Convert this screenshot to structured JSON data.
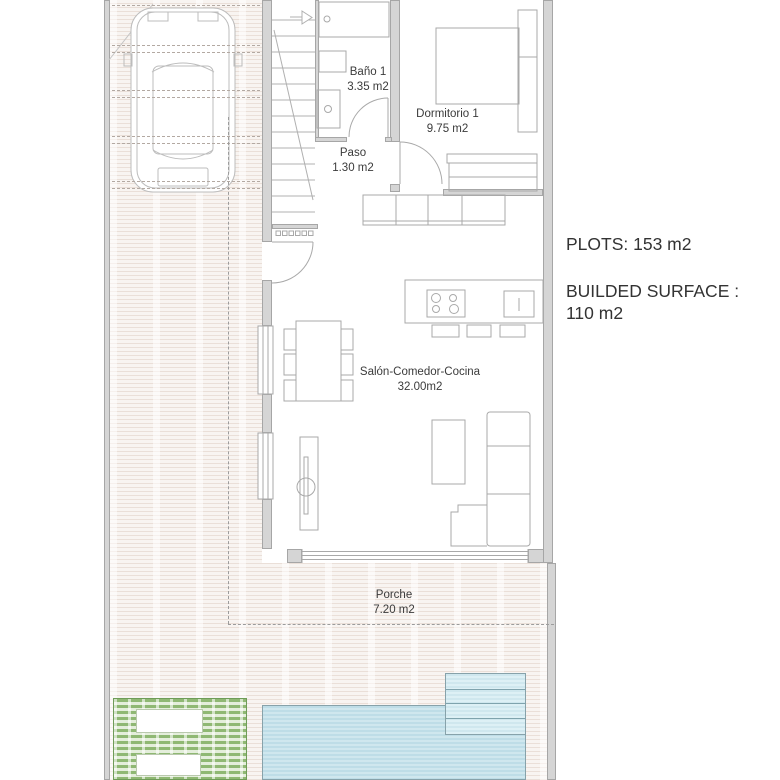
{
  "labels": {
    "rooms": [
      {
        "name": "Baño 1",
        "area": "3.35 m2"
      },
      {
        "name": "Dormitorio 1",
        "area": "9.75 m2"
      },
      {
        "name": "Paso",
        "area": "1.30 m2"
      },
      {
        "name": "Salón-Comedor-Cocina",
        "area": "32.00m2"
      },
      {
        "name": "Porche",
        "area": "7.20 m2"
      }
    ],
    "info": {
      "plots": "PLOTS: 153 m2",
      "built_label": "BUILDED SURFACE :",
      "built_value": "110 m2"
    }
  },
  "colors": {
    "wall_fill": "#d5d5d5",
    "wall_edge": "#a6a6a6",
    "linework": "#a9a9a9",
    "paving_stripe": "#eadfd8",
    "pool_water": "#c9e3eb",
    "pool_edge": "#87a2aa",
    "lawn_green": "#8fb873",
    "text": "#3b3b3b"
  }
}
